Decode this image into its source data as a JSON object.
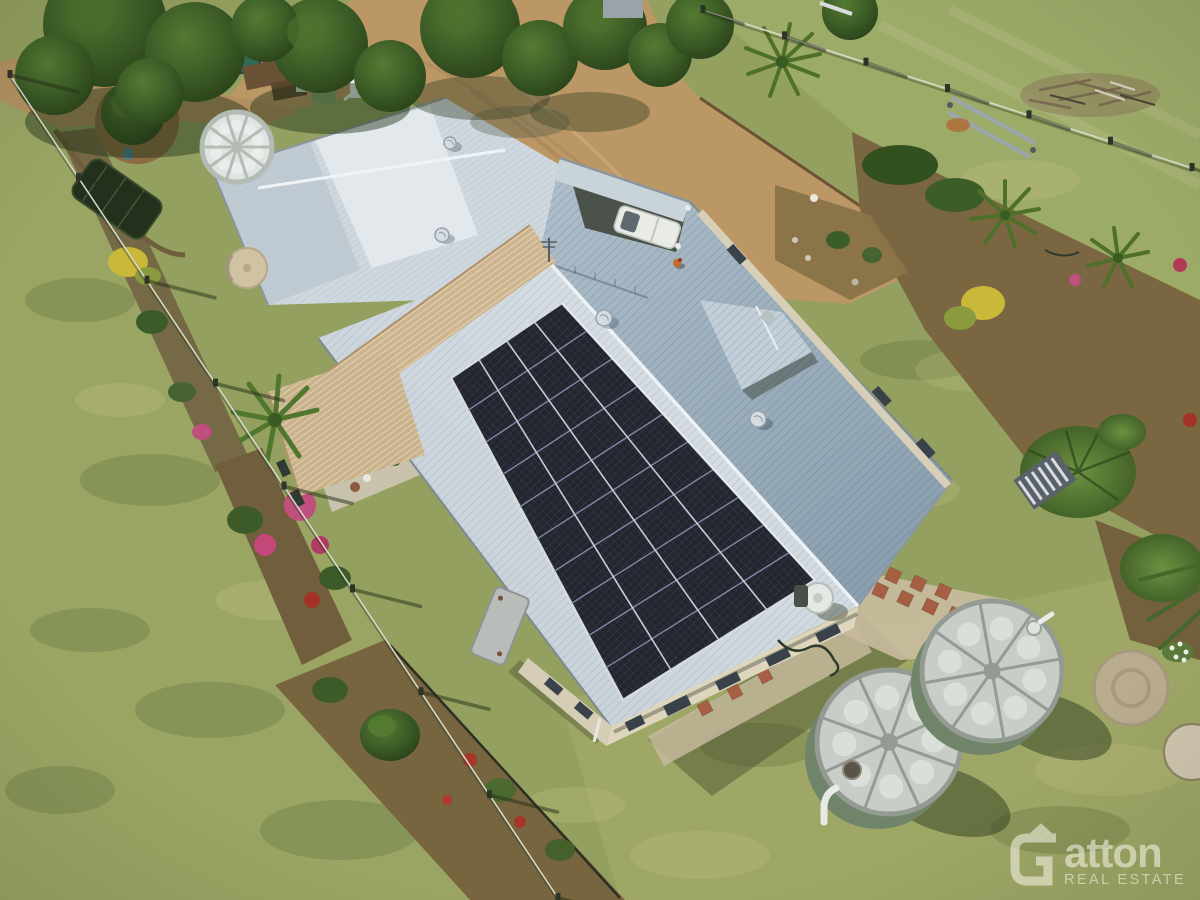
{
  "watermark": {
    "brand": "Gatton",
    "brand_mark": "G",
    "brand_text": "atton",
    "tagline": "REAL ESTATE",
    "color": "#faf7ec",
    "opacity": 0.55
  },
  "scene": {
    "description": "Aerial drone photograph of a rural homestead with rooftop solar panels, two rainwater tanks, gardens, driveway and fenced paddocks",
    "house": {
      "main_roof_color": "#ccd6dd",
      "rear_roof_color": "#a3b4c0",
      "front_wing_roof_color": "#d4dde3",
      "pergola_color": "#cdb58f",
      "wall_color": "#ded5bd",
      "window_color": "#39424b",
      "carport_vehicle": "white utility vehicle",
      "vehicle_color": "#e9ebe7"
    },
    "solar_array": {
      "rows": 4,
      "cols": 10,
      "panel_color": "#23262f",
      "frame_color": "#9196bb",
      "border_color": "#d8dce0"
    },
    "water_tanks": {
      "count": 2,
      "body_color": "#7f9176",
      "body_shade_color": "#6f8468",
      "lid_color": "#c8cec7",
      "lid_rib_color": "#939b93",
      "lid_segments": 8
    },
    "white_tank": {
      "lid_segments": 10,
      "lid_color": "#e0e4e1",
      "rib_color": "#b3bbb5"
    },
    "fences": {
      "left_paddock_posts": 9,
      "right_paddock_posts": 7,
      "wire_color": "#d7dccd",
      "shadow_color": "rgba(35,45,22,0.5)"
    },
    "ground": {
      "grass_color": "#94a05f",
      "driveway_color": "#bb9765",
      "mulch_color": "#715f3e",
      "gravel_color": "#c7bb9e",
      "paver_color": "#a65f42",
      "tree_color": "#35521f"
    }
  }
}
